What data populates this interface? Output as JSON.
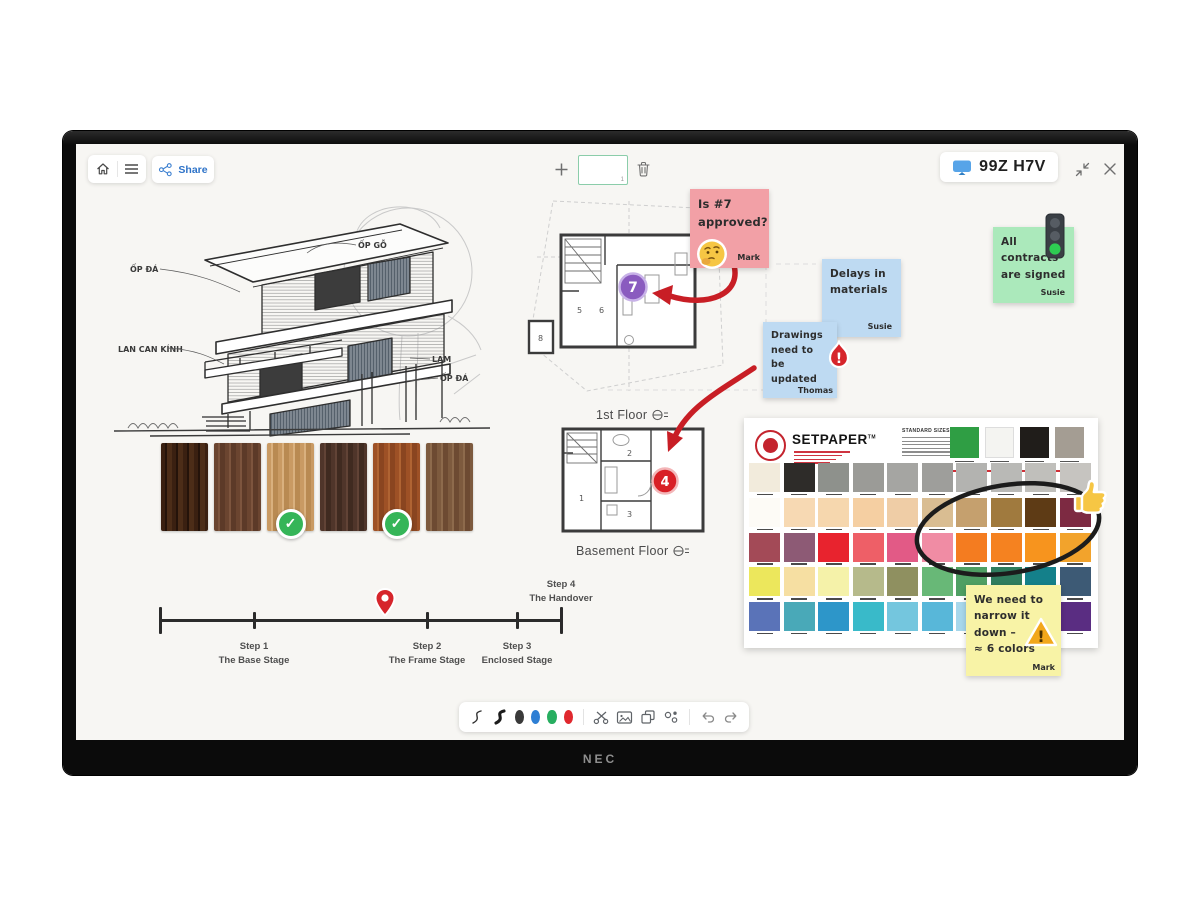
{
  "window": {
    "brand": "NEC"
  },
  "topbar": {
    "share_label": "Share",
    "page_number": "1",
    "session_code": "99Z H7V",
    "icons": [
      "home-icon",
      "hamburger-menu-icon",
      "share-icon",
      "plus-icon",
      "trash-icon",
      "display-icon",
      "collapse-icon",
      "close-icon"
    ]
  },
  "sketch": {
    "annotations": [
      "ỐP ĐÁ",
      "ỐP GỖ",
      "LAN CAN KÍNH",
      "LAM",
      "ỐP ĐÁ"
    ]
  },
  "wood_swatches": {
    "items": [
      {
        "colors": [
          "#3a2011",
          "#24130a",
          "#4c2d18"
        ],
        "approved": false
      },
      {
        "colors": [
          "#6b4530",
          "#7d553e",
          "#5c3a28"
        ],
        "approved": false
      },
      {
        "colors": [
          "#c99a63",
          "#d9b07e",
          "#b98a52"
        ],
        "approved": true
      },
      {
        "colors": [
          "#4f352a",
          "#614336",
          "#3f2a20"
        ],
        "approved": false
      },
      {
        "colors": [
          "#9e5126",
          "#b06433",
          "#8a4520"
        ],
        "approved": true
      },
      {
        "colors": [
          "#7d5a3e",
          "#8d6a4c",
          "#6d4a32"
        ],
        "approved": false
      }
    ]
  },
  "floor_plans": {
    "first": {
      "label": "1st Floor",
      "rooms": [
        "5",
        "6"
      ],
      "outside_room": "8",
      "marker_number": "7",
      "marker_color": "#8a5bbf"
    },
    "basement": {
      "label": "Basement Floor",
      "rooms": [
        "1",
        "2",
        "3"
      ],
      "marker_number": "4",
      "marker_color": "#d81f26"
    }
  },
  "timeline": {
    "marker_icon": "location-pin-icon",
    "steps": [
      {
        "title": "Step 1",
        "subtitle": "The Base Stage"
      },
      {
        "title": "Step 2",
        "subtitle": "The Frame Stage"
      },
      {
        "title": "Step 3",
        "subtitle": "Enclosed Stage"
      },
      {
        "title": "Step 4",
        "subtitle": "The Handover"
      }
    ]
  },
  "sticky_notes": [
    {
      "text": "Is #7\napproved?",
      "author": "Mark",
      "color": "#f2a0a6",
      "icon": "thinking-face-emoji"
    },
    {
      "text": "Delays in\nmaterials",
      "author": "Susie",
      "color": "#bedaf2",
      "icon": ""
    },
    {
      "text": "Drawings\nneed to be\nupdated",
      "author": "Thomas",
      "color": "#bedaf2",
      "icon": "urgent-flame-icon"
    },
    {
      "text": "All\ncontracts\nare signed",
      "author": "Susie",
      "color": "#abe9bb",
      "icon": "traffic-light-icon"
    },
    {
      "text": "We need to\nnarrow it\ndown –\n≈ 6 colors",
      "author": "Mark",
      "color": "#f8f3a6",
      "icon": "warning-triangle-icon"
    }
  ],
  "palette_card": {
    "brand": "SETPAPER",
    "trademark": "TM",
    "sizes_title": "STANDARD SIZES",
    "hero_swatches": [
      "#2f9e44",
      "#f4f4f1",
      "#201d1a",
      "#a49d93"
    ],
    "rows": [
      [
        "#f2ebdc",
        "#2e2c29",
        "#8e918c",
        "#9b9b97",
        "#a5a5a2",
        "#9e9e9b",
        "#b3b3b0",
        "#b9b9b6",
        "#c0bfbb",
        "#c6c4c0"
      ],
      [
        "#fdfbf6",
        "#f7d9b3",
        "#f6d7ae",
        "#f5cfa2",
        "#efcda6",
        "#d9bd92",
        "#c5a06e",
        "#a07a3e",
        "#5e3b15",
        "#7d2a42"
      ],
      [
        "#a34a57",
        "#8d5a75",
        "#e8232e",
        "#ee5f67",
        "#e25a86",
        "#f08ca4",
        "#f47c20",
        "#f58220",
        "#f7941e",
        "#f2a32c"
      ],
      [
        "#ece75c",
        "#f6dfa2",
        "#f5f2a9",
        "#b6ba8b",
        "#8f9060",
        "#68b877",
        "#4f9f63",
        "#2f7d5e",
        "#14808a",
        "#3d5a75"
      ],
      [
        "#5a73b8",
        "#49a9b8",
        "#2d96c9",
        "#39bac9",
        "#74c6de",
        "#58b7d9",
        "#a7d7eb",
        "#33567a",
        "#4a3590",
        "#5a2d82"
      ]
    ],
    "annotations": {
      "circle": "hand-drawn-ellipse",
      "sticker": "thumbs-up-emoji"
    }
  },
  "toolbar": {
    "icons": [
      "pen-thin",
      "pen-thick",
      "color-black",
      "color-blue",
      "color-green",
      "color-red",
      "scissors",
      "image",
      "duplicate",
      "shapes",
      "undo",
      "redo"
    ],
    "colors": {
      "black": "#3a3a3a",
      "blue": "#2e7fd4",
      "green": "#27ae60",
      "red": "#e0282e"
    }
  }
}
